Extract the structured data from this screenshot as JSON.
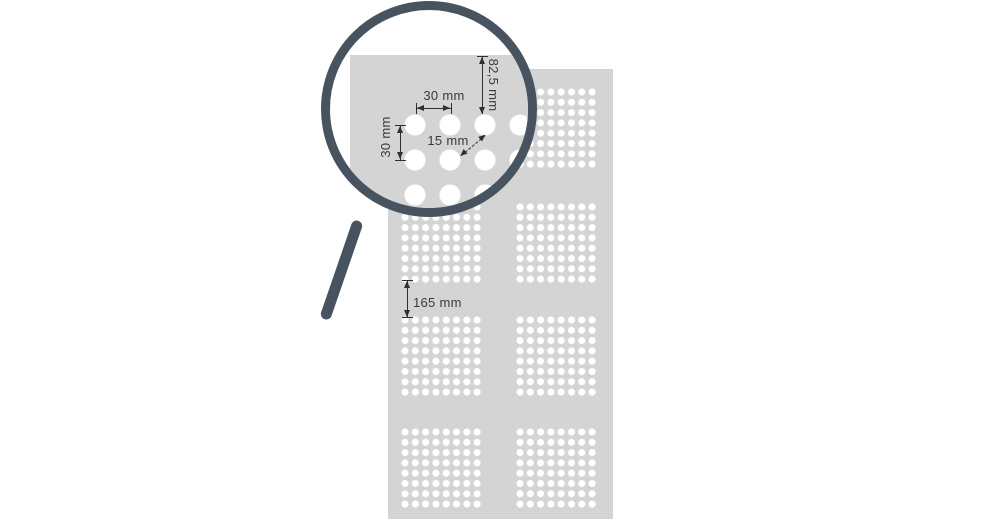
{
  "diagram": {
    "magnifier": {
      "hole_spacing_horizontal": "30 mm",
      "hole_spacing_vertical": "30 mm",
      "diagonal_gap": "15 mm",
      "top_margin": "82,5 mm"
    },
    "panel": {
      "cluster_gap": "165 mm"
    },
    "colors": {
      "background": "#ffffff",
      "panel_gray": "#d4d4d4",
      "hole_white": "#ffffff",
      "magnifier_frame": "#47545f",
      "dimension_ink": "#3a3a3a"
    },
    "icons": {
      "magnifier": "magnifying-glass-icon"
    }
  }
}
